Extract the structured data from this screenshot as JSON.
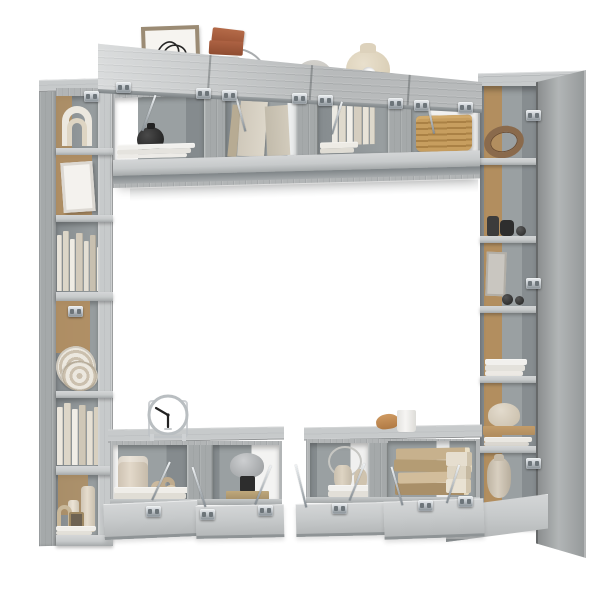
{
  "scene": {
    "description": "Product photo of a gray wood-grain wall-mounted TV cabinet set with open doors, styled with decor objects, on a plain white background",
    "background": "#ffffff"
  },
  "palette": {
    "bg": "#ffffff",
    "wood": "#b2b5b6",
    "wood-light": "#c7cacb",
    "wood-lighter": "#d4d6d7",
    "wood-mid": "#a5a9aa",
    "wood-dark": "#8f9496",
    "interior": "#9aa0a2",
    "interior-dark": "#858b8e",
    "cork": "#b28e5f",
    "cork-light": "#c29c6a",
    "metal-hi": "#eef1f3",
    "metal": "#b9bfc4",
    "metal-dark": "#848c92",
    "cream": "#ded5c3",
    "cream-2": "#cbc0ae",
    "cream-light": "#ece8df",
    "black-item": "#2c2c2c",
    "terracotta": "#b46a48",
    "terracotta-dark": "#9d5537",
    "wicker": "#c79e5f",
    "wicker-dark": "#aa8145",
    "leather": "#8a6a4c",
    "lamp-gray": "#b4b7b9",
    "clock-face": "#ffffff",
    "art-line": "#262626"
  },
  "decor_inventory": [
    "picture-frame-line-art",
    "terracotta-boxes",
    "glass-jar",
    "stone-dome",
    "donut-vase",
    "white-arch-sculpture",
    "leaning-frame",
    "ceramic-plates",
    "candle-set",
    "mini-lantern",
    "black-vase",
    "canvas-boards",
    "wicker-basket",
    "leather-belt",
    "dark-jars",
    "stone-balls",
    "ceramic-bowl",
    "ceramic-urn",
    "table-clock",
    "knot-sculpture",
    "cylinder-vase",
    "mushroom-lamp",
    "wire-ring-sculpture",
    "small-vases",
    "vintage-book-stack",
    "rolled-towels",
    "white-mug",
    "bread-loaf"
  ],
  "books": {
    "left_upper": [
      [
        5,
        56,
        "#e9e4da"
      ],
      [
        6,
        60,
        "#dcd6c8"
      ],
      [
        5,
        52,
        "#efece4"
      ],
      [
        7,
        58,
        "#d2cabb"
      ],
      [
        5,
        50,
        "#e4dfd4"
      ],
      [
        6,
        56,
        "#c8c0b0"
      ],
      [
        5,
        44,
        "#eeeae1"
      ]
    ],
    "left_lower": [
      [
        6,
        58,
        "#ece7dd"
      ],
      [
        7,
        62,
        "#ddd6c8"
      ],
      [
        6,
        56,
        "#f0ede6"
      ],
      [
        7,
        60,
        "#cfc7b7"
      ],
      [
        6,
        54,
        "#e6e0d4"
      ],
      [
        7,
        58,
        "#d8d0c0"
      ]
    ],
    "top_standing": [
      [
        6,
        44,
        "#eceae3"
      ],
      [
        7,
        40,
        "#dfdacd"
      ],
      [
        6,
        46,
        "#f1efe9"
      ],
      [
        8,
        42,
        "#d5cec0"
      ],
      [
        6,
        38,
        "#e8e3d8"
      ],
      [
        5,
        42,
        "#ddd8cb"
      ]
    ]
  },
  "stacks": {
    "top_o1": [
      [
        78,
        5,
        "#f1f0ed",
        0
      ],
      [
        74,
        5,
        "#e5e3de",
        2
      ],
      [
        70,
        4,
        "#edebe7",
        4
      ]
    ],
    "top_o3": [
      [
        38,
        6,
        "#edebe5",
        0
      ],
      [
        34,
        5,
        "#dfdcd4",
        2
      ]
    ],
    "right_books": [
      [
        42,
        6,
        "#f1f0ed",
        0
      ],
      [
        40,
        6,
        "#e3e1db",
        1
      ],
      [
        38,
        5,
        "#ece9e4",
        2
      ]
    ],
    "right_thin": [
      [
        48,
        5,
        "#e9e7e1",
        0
      ],
      [
        45,
        4,
        "#dad7d0",
        1
      ]
    ],
    "a1_books": [
      [
        76,
        6,
        "#efede8",
        0
      ],
      [
        72,
        6,
        "#e0ddd5",
        2
      ]
    ],
    "b1_books": [
      [
        48,
        6,
        "#f0efec",
        0
      ],
      [
        44,
        6,
        "#e2dfd8",
        2
      ]
    ],
    "left_base": [
      [
        40,
        5,
        "#f0eee9",
        0
      ],
      [
        36,
        4,
        "#e3e0d9",
        2
      ]
    ],
    "vintage": [
      [
        74,
        12,
        "#c7b18d",
        "#eadfc6",
        2,
        -1
      ],
      [
        78,
        12,
        "#b49c74",
        "#e6dabf",
        0,
        1
      ],
      [
        70,
        11,
        "#d2bd9b",
        "#f0e6d0",
        4,
        -1
      ],
      [
        74,
        12,
        "#a98f68",
        "#e2d5b8",
        1,
        0
      ]
    ],
    "towels": [
      [
        26,
        14,
        "#e6decf",
        "#cfc3ac",
        0,
        0
      ],
      [
        24,
        13,
        "#ded5c3",
        "#c6b9a1",
        1,
        0
      ],
      [
        25,
        14,
        "#e9e2d3",
        "#d2c6af",
        0,
        0
      ]
    ]
  }
}
